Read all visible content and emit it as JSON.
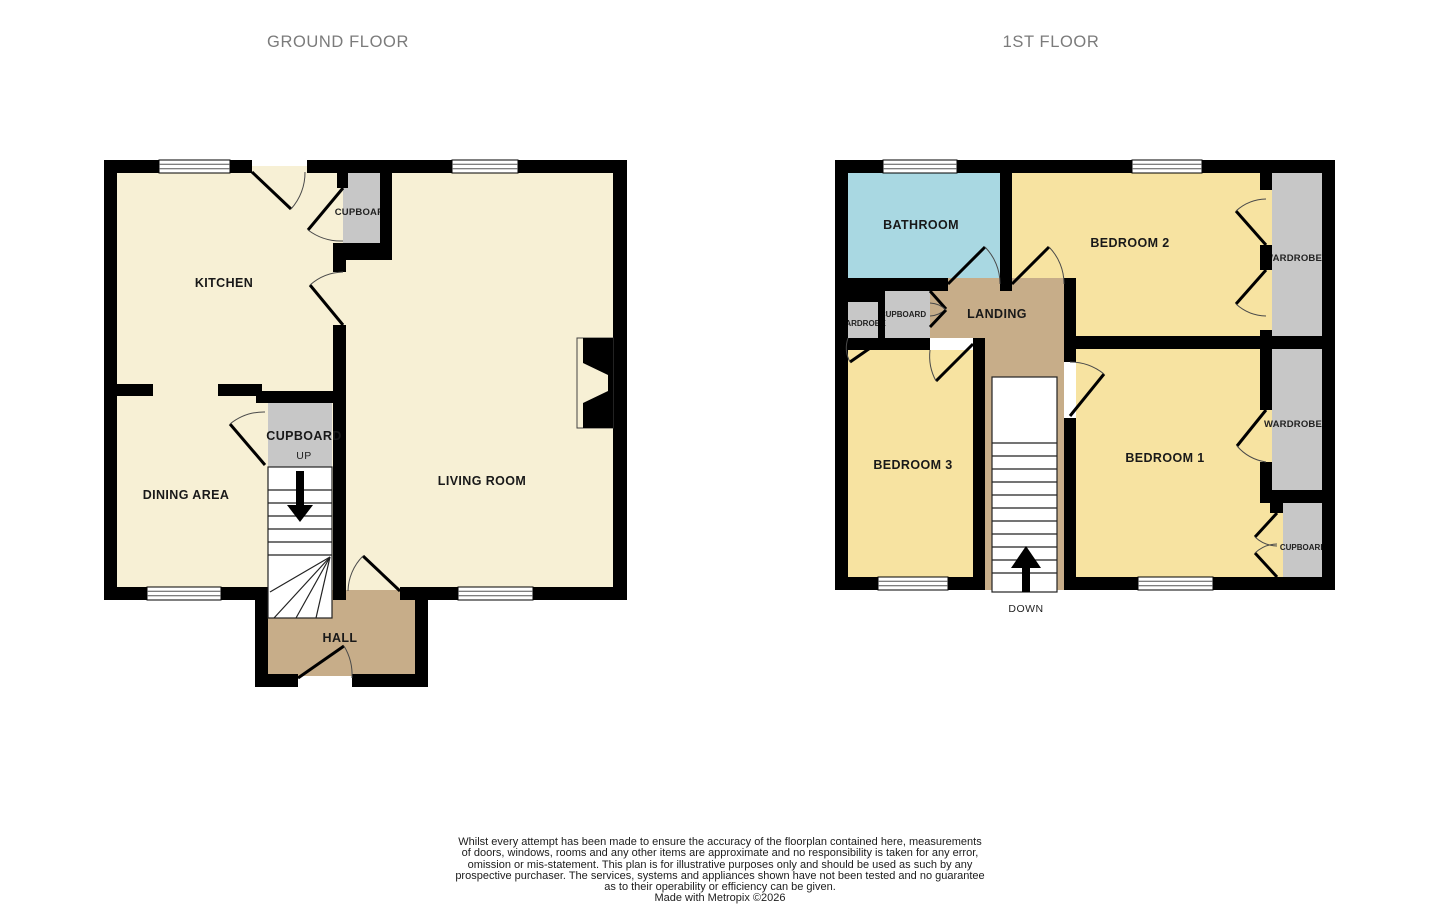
{
  "titles": {
    "ground_floor": "GROUND FLOOR",
    "first_floor": "1ST FLOOR"
  },
  "ground_floor": {
    "labels": {
      "kitchen": "KITCHEN",
      "dining_area": "DINING AREA",
      "living_room": "LIVING ROOM",
      "hall": "HALL",
      "cupboard_kitchen": "CUPBOARD",
      "cupboard_stairs": "CUPBOARD",
      "stairs_direction": "UP"
    }
  },
  "first_floor": {
    "labels": {
      "bathroom": "BATHROOM",
      "bedroom_1": "BEDROOM 1",
      "bedroom_2": "BEDROOM 2",
      "bedroom_3": "BEDROOM 3",
      "landing": "LANDING",
      "wardrobe_bedroom_2": "WARDROBE",
      "wardrobe_bedroom_1": "WARDROBE",
      "wardrobe_bedroom_3": "WARDROBE",
      "cupboard_landing": "CUPBOARD",
      "cupboard_bedroom_1": "CUPBOARD",
      "stairs_direction": "DOWN"
    }
  },
  "footer": {
    "disclaimer_lines": [
      "Whilst every attempt has been made to ensure the accuracy of the floorplan contained here, measurements",
      "of doors, windows, rooms and any other items are approximate and no responsibility is taken for any error,",
      "omission or mis-statement. This plan is for illustrative purposes only and should be used as such by any",
      "prospective purchaser. The services, systems and appliances shown have not been tested and no guarantee",
      "as to their operability or efficiency can be given."
    ],
    "credit": "Made with Metropix ©2026"
  },
  "colors": {
    "wall": "#000000",
    "room_ground": "#f7f0d5",
    "room_bedroom": "#f7e3a1",
    "bathroom": "#a9d8e2",
    "hall_landing": "#c7ad89",
    "storage": "#c7c7c7",
    "stairs": "#ffffff"
  }
}
